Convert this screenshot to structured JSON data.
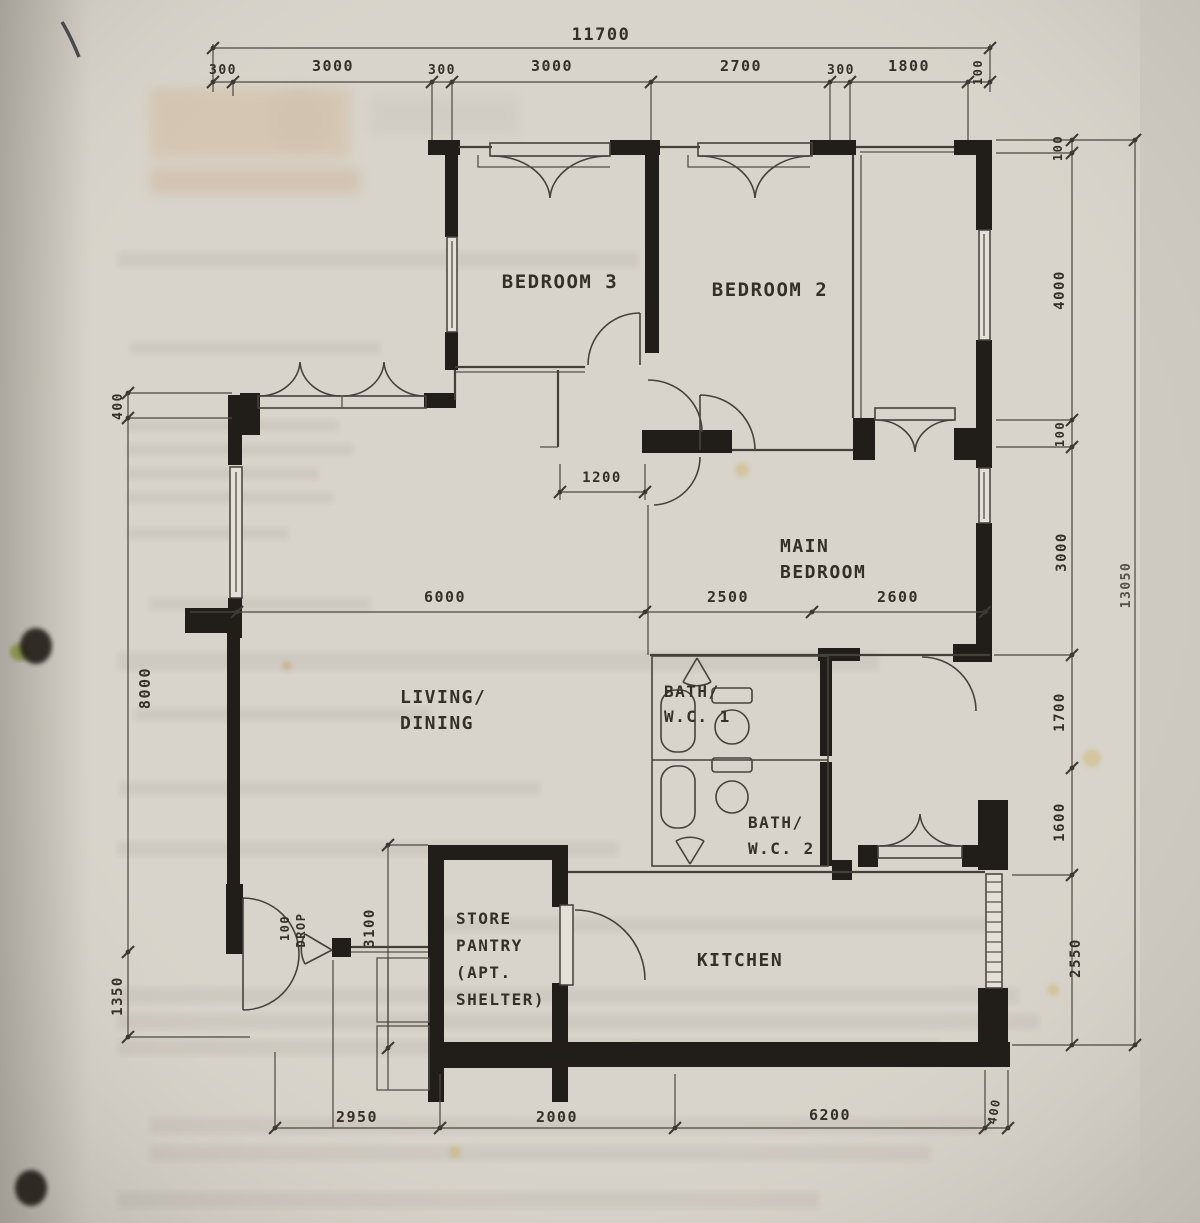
{
  "rooms": {
    "bedroom3": "BEDROOM 3",
    "bedroom2": "BEDROOM 2",
    "main1": "MAIN",
    "main2": "BEDROOM",
    "living1": "LIVING/",
    "living2": "DINING",
    "bath1a": "BATH/",
    "bath1b": "W.C. 1",
    "bath2a": "BATH/",
    "bath2b": "W.C. 2",
    "kitchen": "KITCHEN",
    "store1": "STORE",
    "store2": "PANTRY",
    "store3": "(APT.",
    "store4": "SHELTER)"
  },
  "dims": {
    "top_total": "11700",
    "top": [
      "300",
      "3000",
      "300",
      "3000",
      "2700",
      "300",
      "1800",
      "100"
    ],
    "left": [
      "400",
      "8000",
      "1350"
    ],
    "right": [
      "100",
      "4000",
      "100",
      "3000",
      "1700",
      "1600",
      "2550"
    ],
    "right_total": "13050",
    "bottom": [
      "2950",
      "2000",
      "6200",
      "400"
    ],
    "inner": {
      "living": "6000",
      "hall": "2500",
      "main": "2600",
      "door": "1200",
      "store": "3100"
    }
  },
  "ann": {
    "drop1": "100",
    "drop2": "DROP"
  },
  "colors": {
    "paper": "#d8d4cb",
    "ink": "#33302a",
    "wall": "#211e1a"
  }
}
